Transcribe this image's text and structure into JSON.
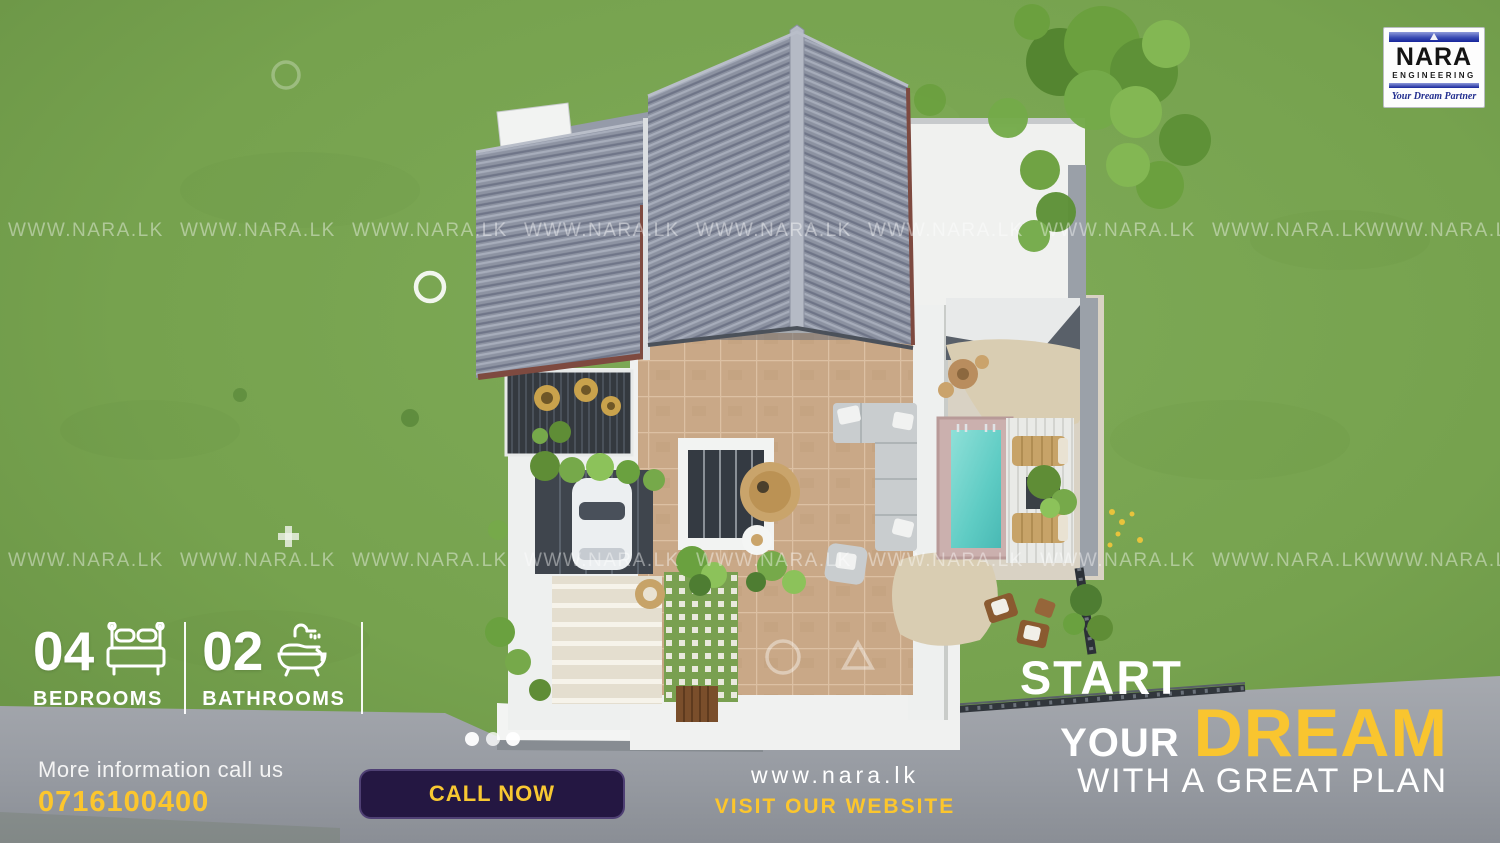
{
  "watermark": {
    "text": "WWW.NARA.LK",
    "rows": [
      220,
      550
    ],
    "columns": [
      8,
      180,
      352,
      524,
      696,
      868,
      1040,
      1212,
      1366
    ]
  },
  "logo": {
    "name": "NARA",
    "sub": "ENGINEERING",
    "tagline": "Your Dream Partner"
  },
  "stats": [
    {
      "value": "04",
      "label": "BEDROOMS",
      "icon": "bed-icon"
    },
    {
      "value": "02",
      "label": "BATHROOMS",
      "icon": "bathtub-icon"
    }
  ],
  "contact": {
    "info_label": "More information call us",
    "phone": "0716100400",
    "call_button": "CALL NOW",
    "website": "www.nara.lk",
    "website_cta": "VISIT OUR WEBSITE"
  },
  "headline": {
    "line1": "START",
    "line2_small": "YOUR",
    "line2_big": "DREAM",
    "line3": "WITH A GREAT PLAN"
  },
  "colors": {
    "accent_yellow": "#fcc62d",
    "button_bg": "#241742",
    "grass": "#77a24f",
    "road": "#9aa0a6",
    "roof_gray": "#8b91a0",
    "pool": "#5fccc4",
    "logo_blue": "#2436a0"
  }
}
